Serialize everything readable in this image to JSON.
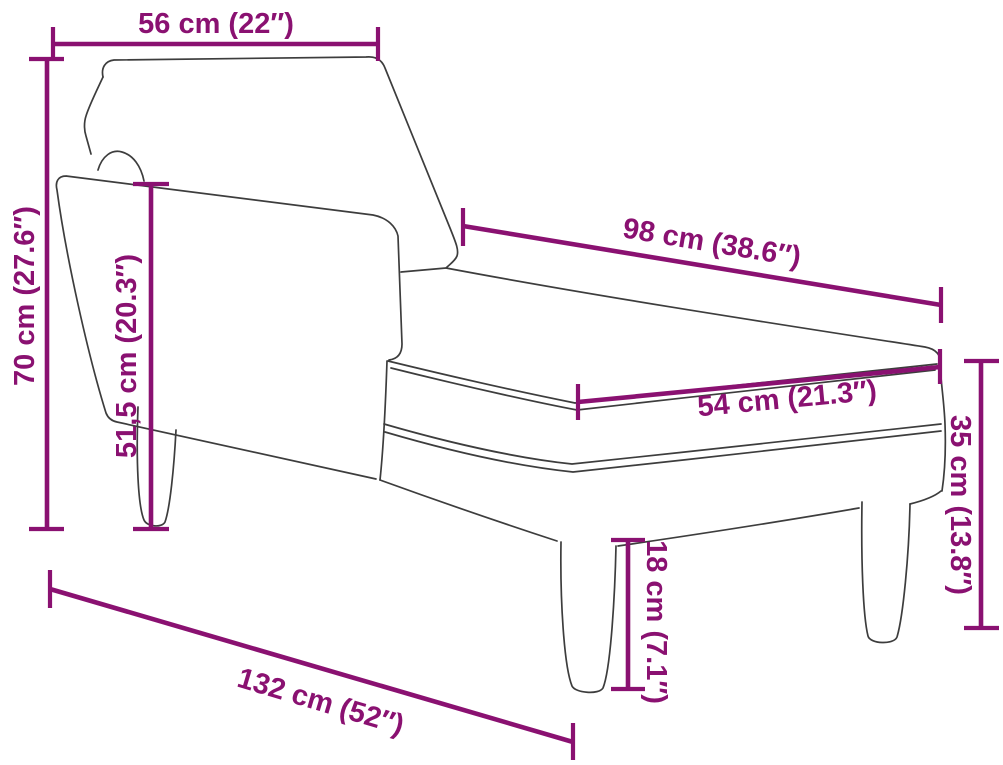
{
  "diagram": {
    "title": "Chaise longue dimension diagram",
    "subject": "chaise-longue-line-drawing",
    "unit_primary": "cm",
    "unit_secondary": "in",
    "accent_color": "#8a1171",
    "outline_color": "#3d3d3d",
    "background_color": "#ffffff",
    "dimensions": [
      {
        "id": "top-width",
        "cm": "56",
        "in": "22",
        "label": "56 cm (22″)"
      },
      {
        "id": "total-height",
        "cm": "70",
        "in": "27.6",
        "label": "70 cm (27.6″)"
      },
      {
        "id": "backrest-height",
        "cm": "51,5",
        "in": "20.3",
        "label": "51,5 cm (20.3″)"
      },
      {
        "id": "seat-length",
        "cm": "98",
        "in": "38.6",
        "label": "98 cm (38.6″)"
      },
      {
        "id": "seat-width",
        "cm": "54",
        "in": "21.3",
        "label": "54 cm (21.3″)"
      },
      {
        "id": "side-height",
        "cm": "35",
        "in": "13.8",
        "label": "35 cm (13.8″)"
      },
      {
        "id": "leg-height",
        "cm": "18",
        "in": "7.1",
        "label": "18 cm (7.1″)"
      },
      {
        "id": "total-length",
        "cm": "132",
        "in": "52",
        "label": "132 cm (52″)"
      }
    ]
  }
}
